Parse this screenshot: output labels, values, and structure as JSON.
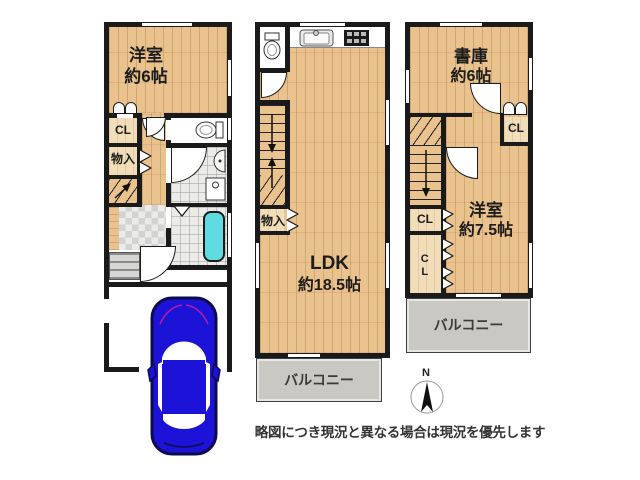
{
  "caption": "略図につき現況と異なる場合は現況を優先します",
  "compass": {
    "north_label": "N"
  },
  "floors": {
    "f1": {
      "western_room_name": "洋室",
      "western_room_size": "約6帖",
      "closet": "CL",
      "storage": "物入"
    },
    "f2": {
      "ldk_name": "LDK",
      "ldk_size": "約18.5帖",
      "storage": "物入",
      "balcony": "バルコニー"
    },
    "f3": {
      "library_name": "書庫",
      "library_size": "約6帖",
      "closet_top": "CL",
      "closet_mid": "CL",
      "closet_bottom": "CL",
      "western_room_name": "洋室",
      "western_room_size": "約7.5帖",
      "balcony": "バルコニー"
    }
  },
  "colors": {
    "wall": "#1a1a1a",
    "wood_floor": "#eac28d",
    "tile": "#ebebe9",
    "balcony": "#c9c8c2",
    "bathtub": "#5fdce2",
    "car_body": "#1c12d8",
    "car_outline": "#0b0b4d"
  }
}
